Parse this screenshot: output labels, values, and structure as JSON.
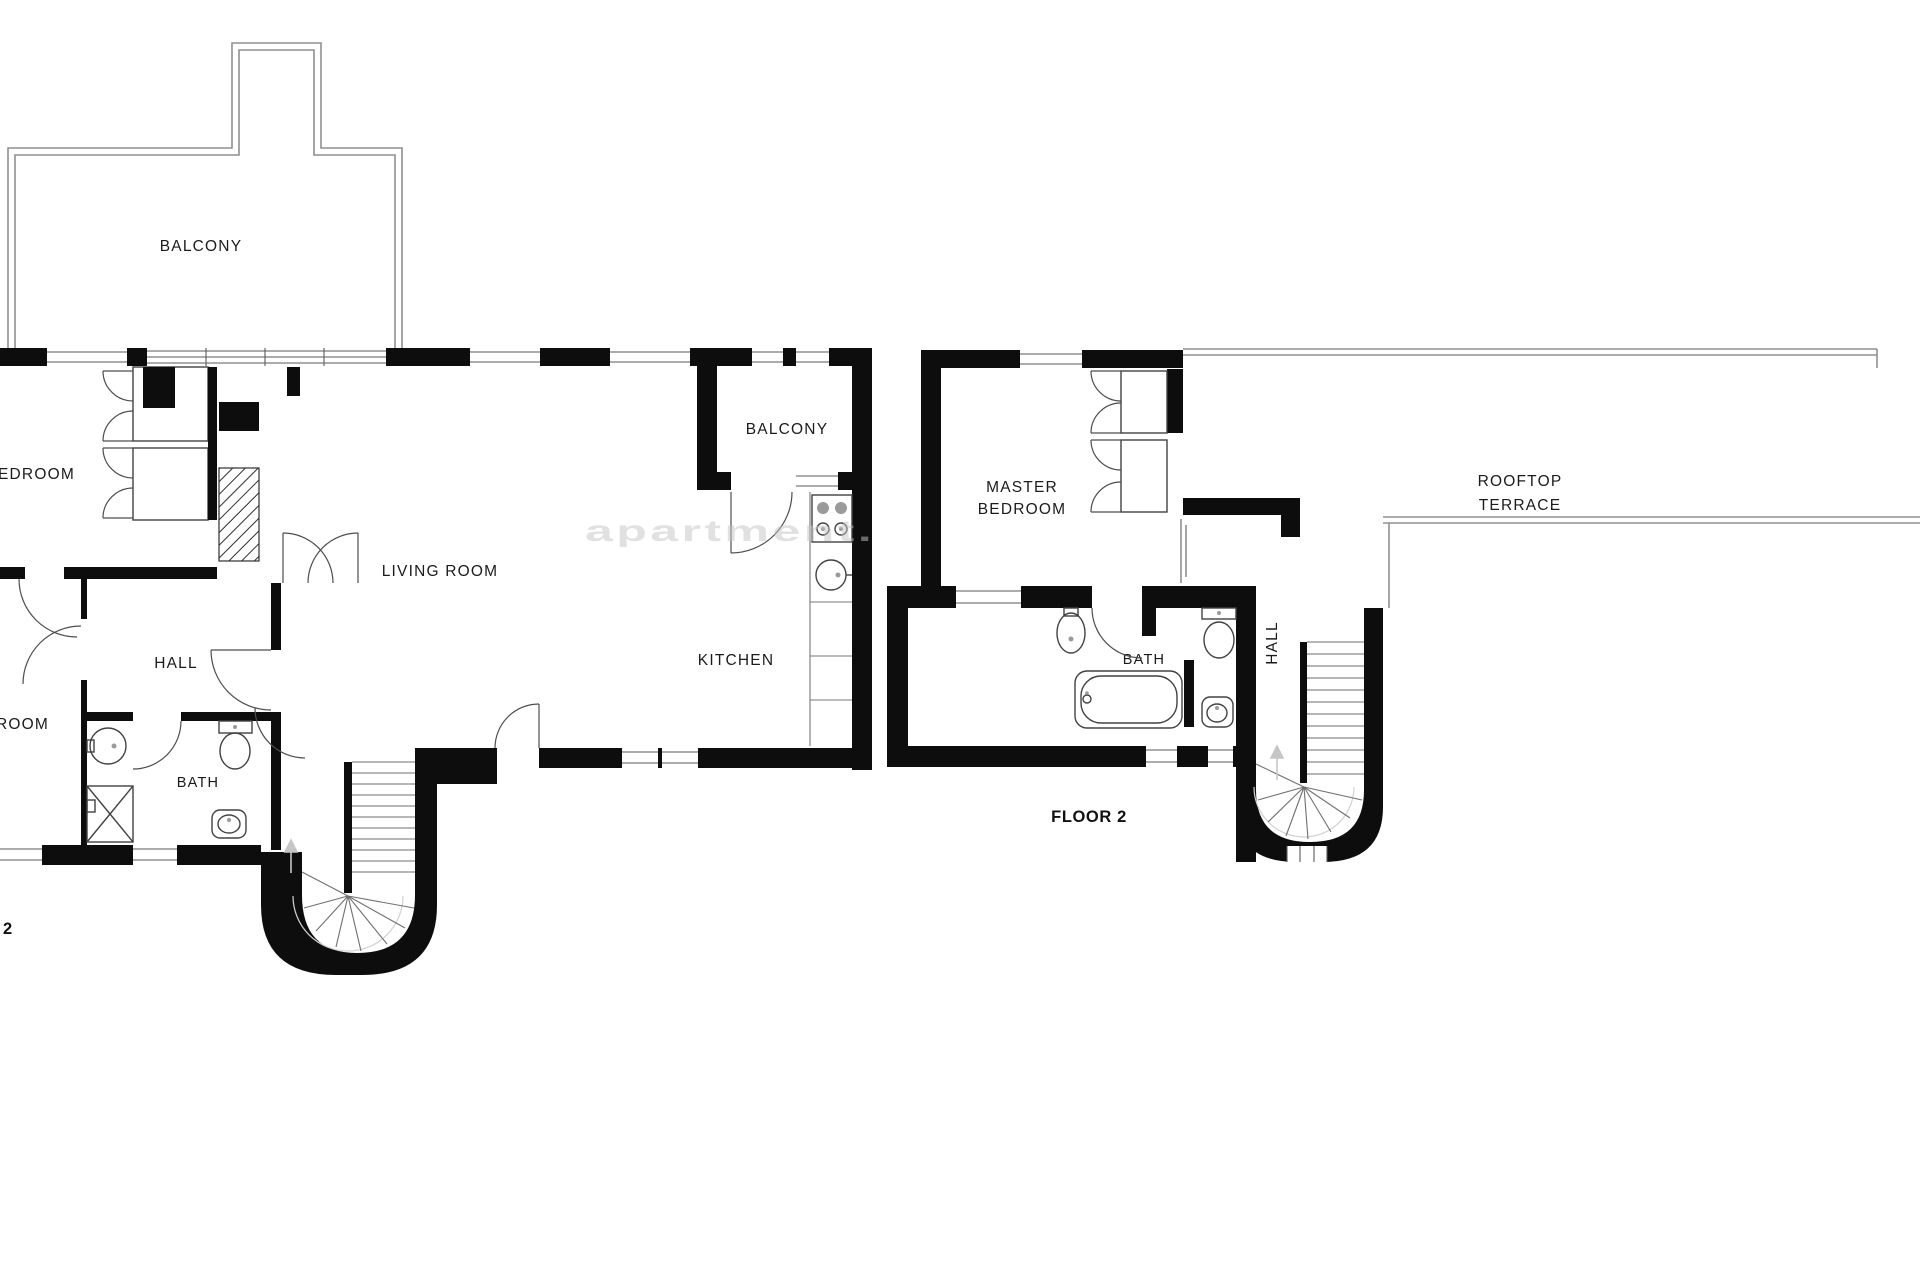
{
  "colors": {
    "wall": "#0d0d0d",
    "thin_wall": "#8f8f8f",
    "fixture_line": "#424242",
    "label_text": "#1b1b1b",
    "watermark": "#c4c4c4",
    "background": "#ffffff"
  },
  "watermark": {
    "text": "apartment."
  },
  "floor1": {
    "balcony_top_label": "BALCONY",
    "bedroom_label": "EDROOM",
    "living_room_label": "LIVING ROOM",
    "balcony_right_label": "BALCONY",
    "kitchen_label": "KITCHEN",
    "hall_label": "HALL",
    "bath_label": "BATH",
    "bedroom2_label": "ROOM",
    "floor_number": "2"
  },
  "floor2": {
    "master_bedroom_line1": "MASTER",
    "master_bedroom_line2": "BEDROOM",
    "terrace_line1": "ROOFTOP",
    "terrace_line2": "TERRACE",
    "bath_label": "BATH",
    "hall_label": "HALL",
    "floor_caption": "FLOOR 2"
  }
}
